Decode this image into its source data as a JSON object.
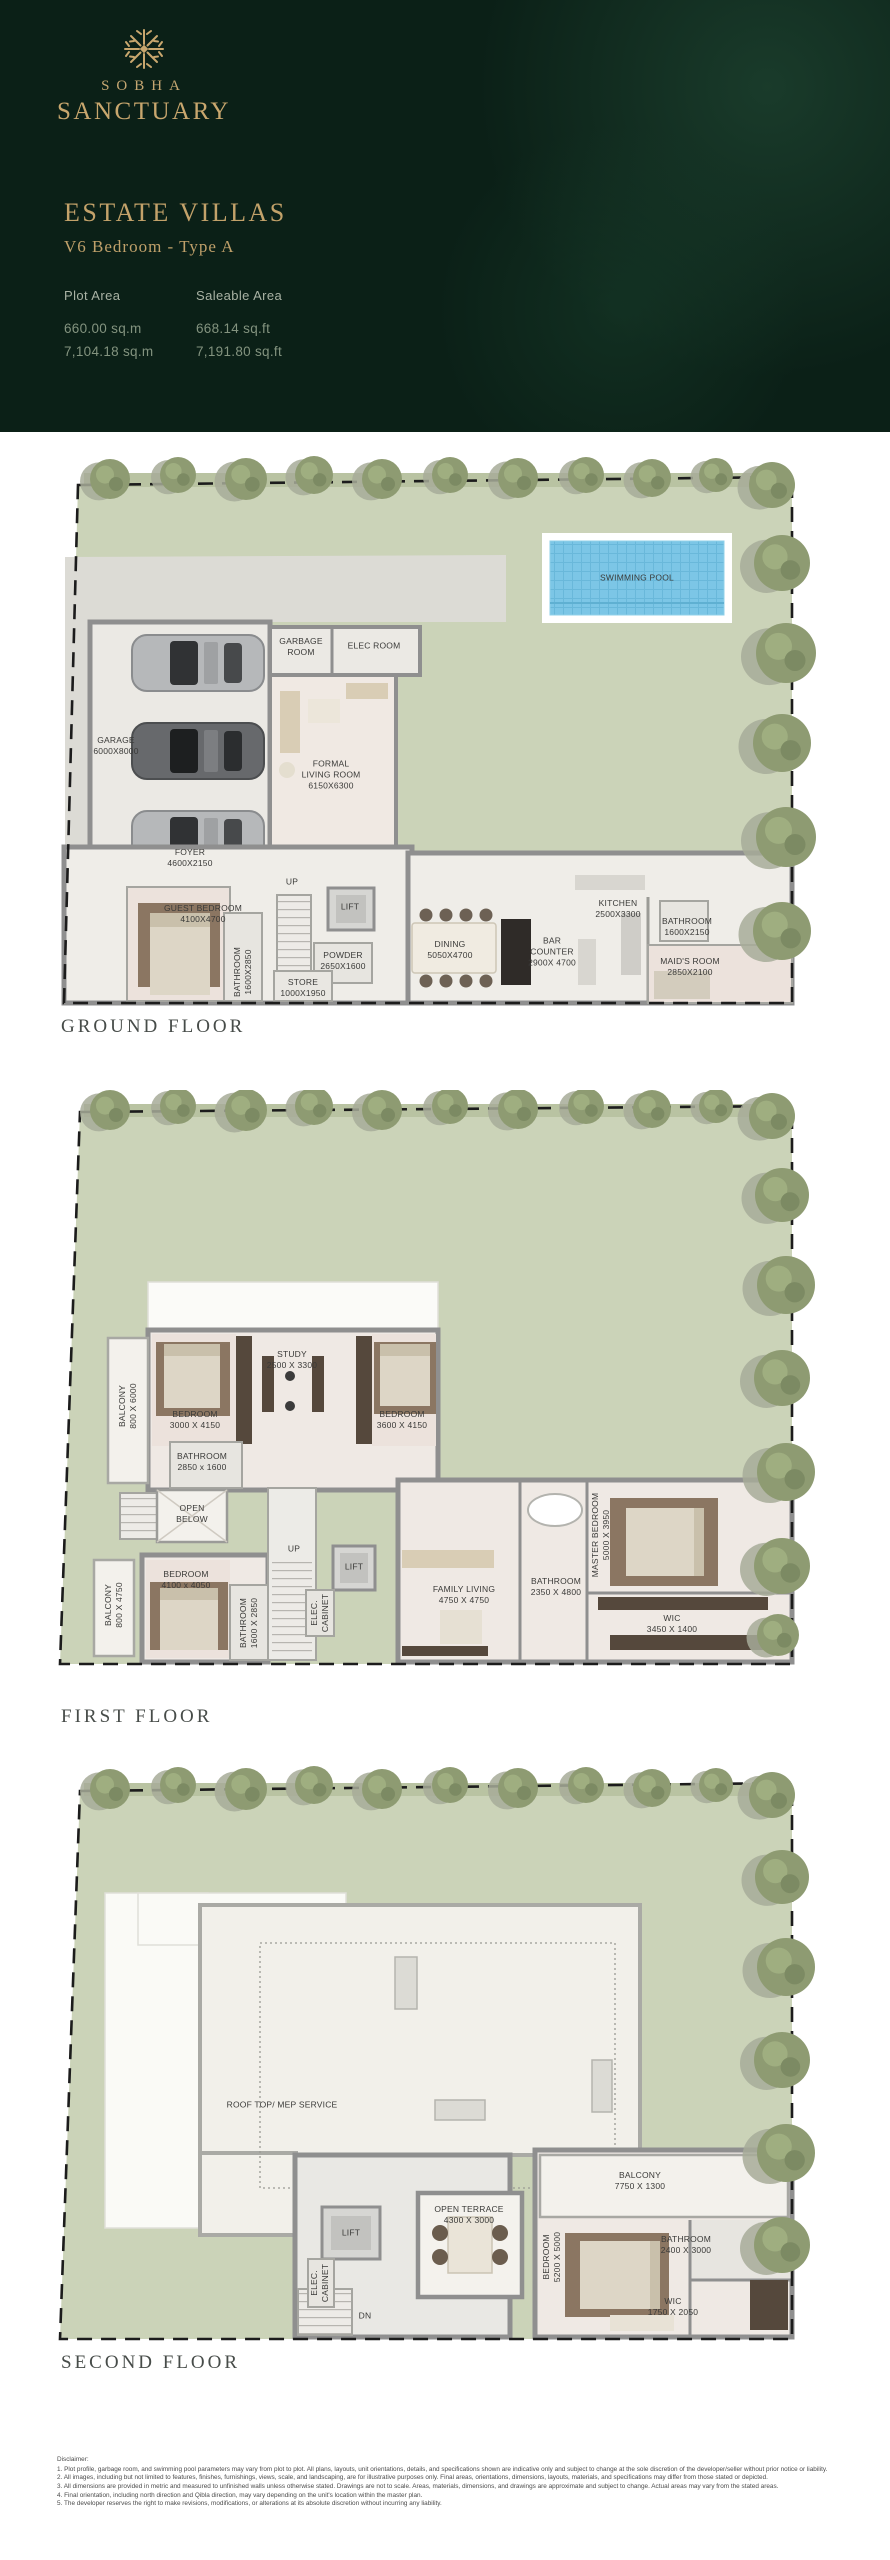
{
  "header": {
    "brand": {
      "icon": "coral-starburst-icon",
      "top": "SOBHA",
      "bottom": "SANCTUARY"
    },
    "collection_title": "ESTATE VILLAS",
    "unit_type": "V6 Bedroom - Type A",
    "area_columns": [
      {
        "label": "Plot Area",
        "values": [
          "660.00 sq.m",
          "7,104.18 sq.m"
        ]
      },
      {
        "label": "Saleable Area",
        "values": [
          "668.14 sq.ft",
          "7,191.80 sq.ft"
        ]
      }
    ],
    "colors": {
      "background": "#0b2017",
      "gold": "#c3a26a",
      "grass": "#cbd3b8",
      "pool": "#7cc6e6"
    }
  },
  "floors": [
    {
      "id": "ground",
      "title": "GROUND FLOOR",
      "labels": [
        {
          "lines": [
            "SWIMMING POOL"
          ],
          "x": 587,
          "y": 133
        },
        {
          "lines": [
            "GARAGE",
            "6000X8000"
          ],
          "x": 66,
          "y": 301
        },
        {
          "lines": [
            "GARBAGE",
            "ROOM"
          ],
          "x": 251,
          "y": 202
        },
        {
          "lines": [
            "ELEC ROOM"
          ],
          "x": 324,
          "y": 201
        },
        {
          "lines": [
            "FORMAL",
            "LIVING ROOM",
            "6150X6300"
          ],
          "x": 281,
          "y": 330
        },
        {
          "lines": [
            "FOYER",
            "4600X2150"
          ],
          "x": 140,
          "y": 413
        },
        {
          "lines": [
            "UP"
          ],
          "x": 242,
          "y": 437
        },
        {
          "lines": [
            "LIFT"
          ],
          "x": 300,
          "y": 462
        },
        {
          "lines": [
            "GUEST BEDROOM",
            "4100X4700"
          ],
          "x": 153,
          "y": 469
        },
        {
          "lines": [
            "BATHROOM",
            "1600X2850"
          ],
          "x": 193,
          "y": 527,
          "rot": -90
        },
        {
          "lines": [
            "POWDER",
            "2650X1600"
          ],
          "x": 293,
          "y": 516
        },
        {
          "lines": [
            "STORE",
            "1000X1950"
          ],
          "x": 253,
          "y": 543
        },
        {
          "lines": [
            "DINING",
            "5050X4700"
          ],
          "x": 400,
          "y": 505
        },
        {
          "lines": [
            "BAR",
            "COUNTER",
            "2900X 4700"
          ],
          "x": 502,
          "y": 507
        },
        {
          "lines": [
            "KITCHEN",
            "2500X3300"
          ],
          "x": 568,
          "y": 464
        },
        {
          "lines": [
            "BATHROOM",
            "1600X2150"
          ],
          "x": 637,
          "y": 482
        },
        {
          "lines": [
            "MAID'S ROOM",
            "2850X2100"
          ],
          "x": 640,
          "y": 522
        }
      ]
    },
    {
      "id": "first",
      "title": "FIRST FLOOR",
      "labels": [
        {
          "lines": [
            "BALCONY",
            "800 X 6000"
          ],
          "x": 78,
          "y": 316,
          "rot": -90
        },
        {
          "lines": [
            "BEDROOM",
            "3000 X 4150"
          ],
          "x": 145,
          "y": 330
        },
        {
          "lines": [
            "STUDY",
            "2500 X 3300"
          ],
          "x": 242,
          "y": 270
        },
        {
          "lines": [
            "BEDROOM",
            "3600 X 4150"
          ],
          "x": 352,
          "y": 330
        },
        {
          "lines": [
            "BATHROOM",
            "2850 x 1600"
          ],
          "x": 152,
          "y": 372
        },
        {
          "lines": [
            "OPEN",
            "BELOW"
          ],
          "x": 142,
          "y": 424
        },
        {
          "lines": [
            "BALCONY",
            "800 X 4750"
          ],
          "x": 64,
          "y": 515,
          "rot": -90
        },
        {
          "lines": [
            "BEDROOM",
            "4100 x 4050"
          ],
          "x": 136,
          "y": 490
        },
        {
          "lines": [
            "BATHROOM",
            "1600 X 2850"
          ],
          "x": 199,
          "y": 533,
          "rot": -90
        },
        {
          "lines": [
            "UP"
          ],
          "x": 244,
          "y": 459
        },
        {
          "lines": [
            "LIFT"
          ],
          "x": 304,
          "y": 477
        },
        {
          "lines": [
            "ELEC.",
            "CABINET"
          ],
          "x": 270,
          "y": 523,
          "rot": -90
        },
        {
          "lines": [
            "FAMILY LIVING",
            "4750 X 4750"
          ],
          "x": 414,
          "y": 505
        },
        {
          "lines": [
            "BATHROOM",
            "2350 X 4800"
          ],
          "x": 506,
          "y": 497
        },
        {
          "lines": [
            "MASTER BEDROOM",
            "5000 X 3950"
          ],
          "x": 551,
          "y": 445,
          "rot": -90
        },
        {
          "lines": [
            "WIC",
            "3450 X 1400"
          ],
          "x": 622,
          "y": 534
        }
      ]
    },
    {
      "id": "second",
      "title": "SECOND FLOOR",
      "labels": [
        {
          "lines": [
            "ROOF TOP/ MEP SERVICE"
          ],
          "x": 232,
          "y": 340
        },
        {
          "lines": [
            "LIFT"
          ],
          "x": 301,
          "y": 468
        },
        {
          "lines": [
            "ELEC.",
            "CABINET"
          ],
          "x": 270,
          "y": 518,
          "rot": -90
        },
        {
          "lines": [
            "DN"
          ],
          "x": 315,
          "y": 551
        },
        {
          "lines": [
            "OPEN TERRACE",
            "4300 X 3000"
          ],
          "x": 419,
          "y": 450
        },
        {
          "lines": [
            "BALCONY",
            "7750 X 1300"
          ],
          "x": 590,
          "y": 416
        },
        {
          "lines": [
            "BEDROOM",
            "5200 X 5000"
          ],
          "x": 502,
          "y": 492,
          "rot": -90
        },
        {
          "lines": [
            "BATHROOM",
            "2400 X 3000"
          ],
          "x": 636,
          "y": 480
        },
        {
          "lines": [
            "WIC",
            "1750 X 2050"
          ],
          "x": 623,
          "y": 542
        }
      ]
    }
  ],
  "disclaimer": {
    "title": "Disclaimer:",
    "lines": [
      "1. Plot profile, garbage room, and swimming pool parameters may vary from plot to plot. All plans, layouts, unit orientations, details, and specifications shown are indicative only and subject to change at the sole discretion of the developer/seller without prior notice or liability.",
      "2. All images, including but not limited to features, finishes, furnishings, views, scale, and landscaping, are for illustrative purposes only. Final areas, orientations, dimensions, layouts, materials, and specifications may differ from those stated or depicted.",
      "3. All dimensions are provided in metric and measured to unfinished walls unless otherwise stated. Drawings are not to scale. Areas, materials, dimensions, and drawings are approximate and subject to change. Actual areas may vary from the stated areas.",
      "4. Final orientation, including north direction and Qibla direction, may vary depending on the unit's location within the master plan.",
      "5. The developer reserves the right to make revisions, modifications, or alterations at its absolute discretion without incurring any liability."
    ]
  }
}
